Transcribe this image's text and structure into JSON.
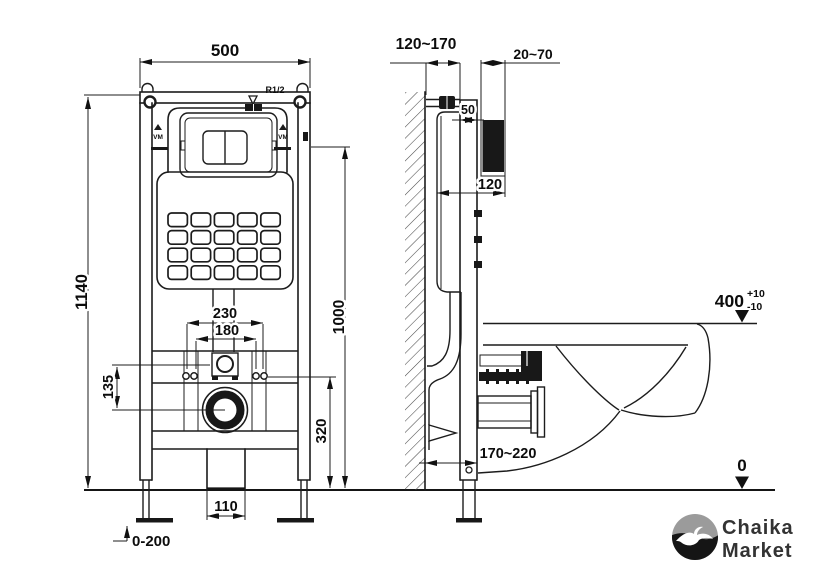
{
  "front_view": {
    "frame_width": "500",
    "frame_height": "1140",
    "water_inlet": "R1/2",
    "fixing_span_outer": "230",
    "fixing_span_inner": "180",
    "inlet_to_drain": "135",
    "flush_center_height": "1000",
    "fixing_height": "320",
    "drain_box_width": "110",
    "leg_adjust_range": "0-200",
    "plate_mark_left": "VM",
    "plate_mark_right": "VM"
  },
  "side_view": {
    "wall_to_frame_depth": "120~170",
    "finish_thickness": "20~70",
    "rail_depth": "50",
    "housing_depth": "120",
    "wall_to_leg_depth": "170~220",
    "bowl_height": "400",
    "tolerance_plus": "+10",
    "tolerance_minus": "-10",
    "floor_level": "0"
  },
  "logo": {
    "line1": "Chaika",
    "line2": "Market"
  },
  "colors": {
    "line": "#1c1c1c",
    "background": "#ffffff",
    "logo_gray": "#9b9b9b",
    "logo_black": "#151515",
    "text": "#0c0c0c"
  }
}
